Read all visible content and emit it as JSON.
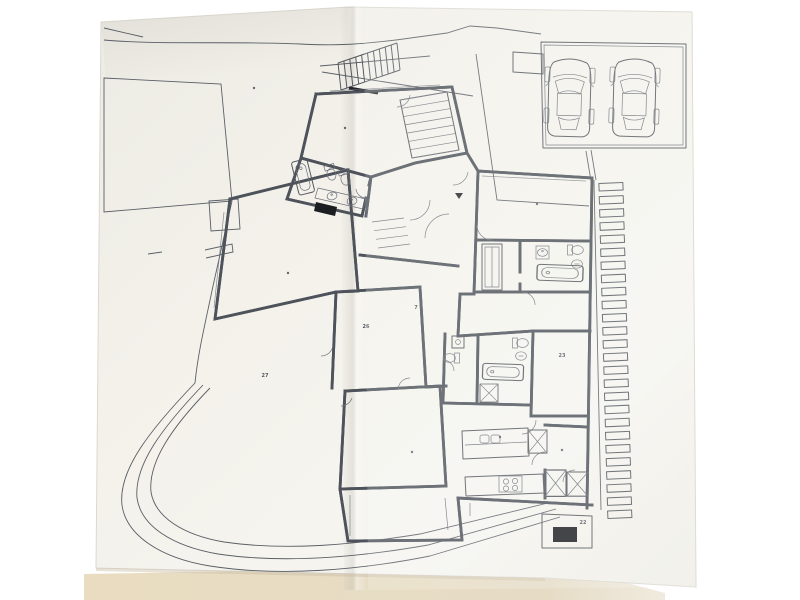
{
  "photo": {
    "subject": "Hand-drafted architectural ground-floor plan, photographed on a folded white sheet",
    "sheet": "white drawing sheet with a vertical fold crease",
    "surface": "beige table surface visible along the bottom edge"
  },
  "colors": {
    "background": "#ffffff",
    "paper": "#f3f1ea",
    "paper_shade": "#e7e4dc",
    "table": "#e8dcc2",
    "line": "#4e535b",
    "line_light": "#7d828a",
    "black_fill": "#1b1d20"
  },
  "plan": {
    "room_markers": [
      {
        "x": 254,
        "y": 88,
        "text": ""
      },
      {
        "x": 345,
        "y": 128,
        "text": ""
      },
      {
        "x": 537,
        "y": 204,
        "text": ""
      },
      {
        "x": 288,
        "y": 273,
        "text": ""
      },
      {
        "x": 416,
        "y": 309,
        "text": "7"
      },
      {
        "x": 366,
        "y": 328,
        "text": "26"
      },
      {
        "x": 265,
        "y": 377,
        "text": "27"
      },
      {
        "x": 562,
        "y": 357,
        "text": "23"
      },
      {
        "x": 562,
        "y": 450,
        "text": ""
      },
      {
        "x": 412,
        "y": 452,
        "text": ""
      },
      {
        "x": 500,
        "y": 437,
        "text": ""
      },
      {
        "x": 583,
        "y": 524,
        "text": "22"
      }
    ],
    "section_arrows": [
      {
        "x": 459,
        "y": 196
      }
    ],
    "garden_steps": {
      "count": 26,
      "x_start": 599,
      "y_start": 183,
      "pitch": 13.1,
      "width": 24,
      "height": 7.5,
      "x_drift": 0.35,
      "tilt_deg": -2.5
    },
    "garage": {
      "car_positions": [
        {
          "x": 549,
          "y": 55
        },
        {
          "x": 614,
          "y": 55
        }
      ]
    },
    "fixture_icons": [
      "car-icon",
      "bathtub-icon",
      "toilet-icon",
      "bidet-icon",
      "sink-icon",
      "stove-icon",
      "kitchen-sink-icon",
      "stairs-icon",
      "shaft-x-icon"
    ]
  }
}
